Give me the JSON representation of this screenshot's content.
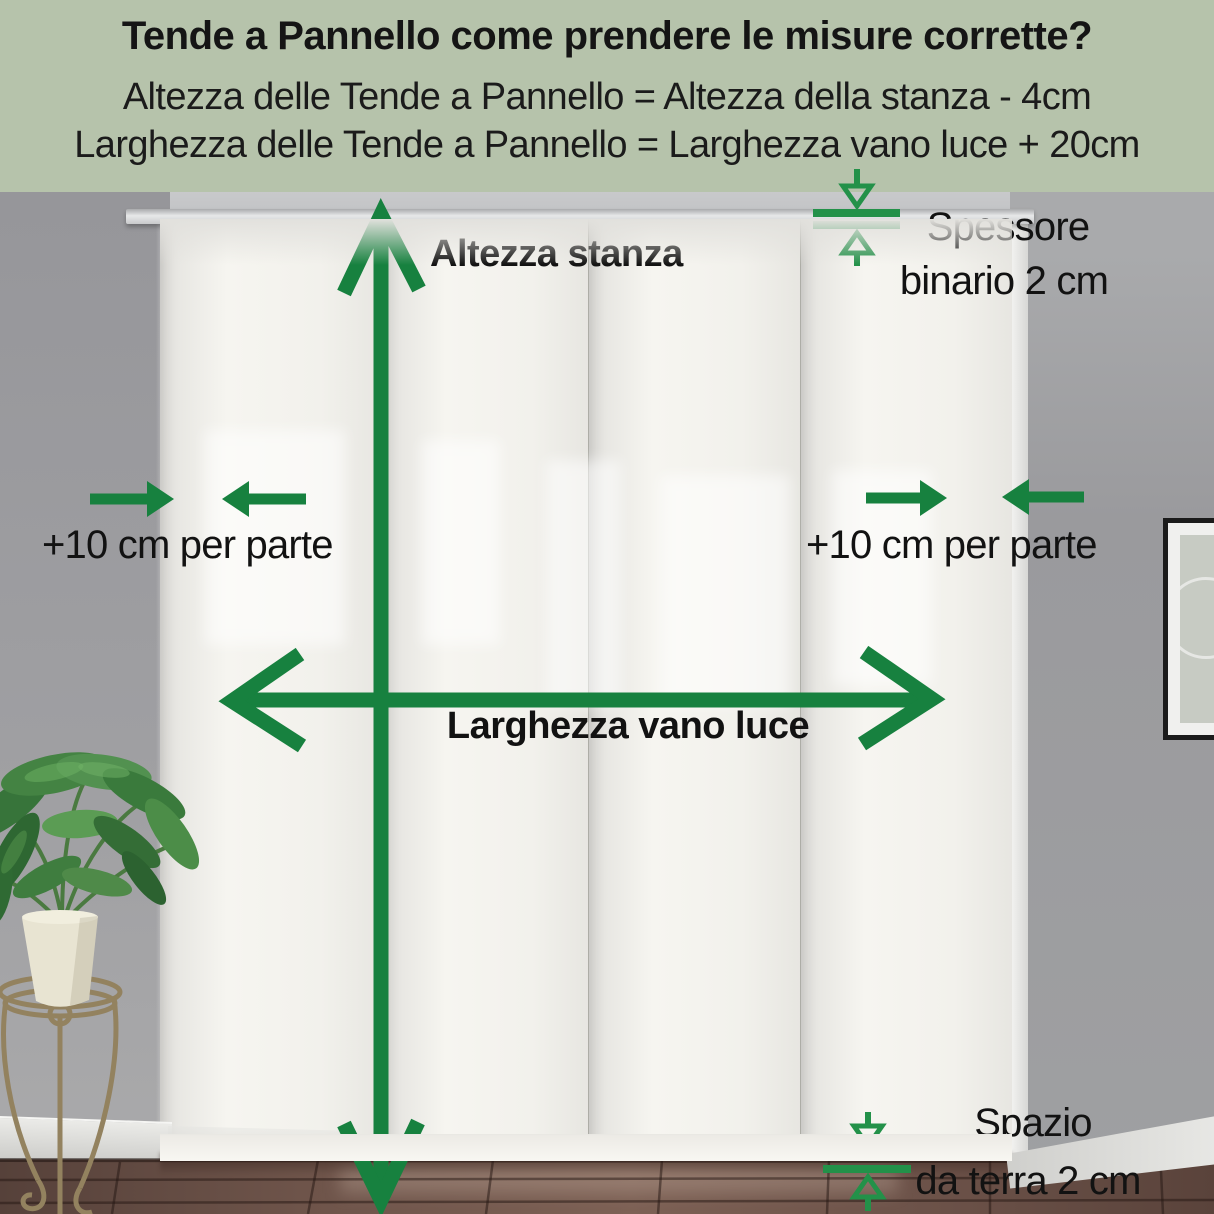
{
  "header": {
    "title": "Tende a Pannello come prendere le misure corrette?",
    "formula_height": "Altezza delle Tende a Pannello = Altezza della stanza - 4cm",
    "formula_width": "Larghezza delle Tende a Pannello = Larghezza vano luce + 20cm"
  },
  "annotations": {
    "room_height_label": "Altezza stanza",
    "opening_width_label": "Larghezza vano luce",
    "track_thickness_label_line1": "Spessore",
    "track_thickness_label_line2": "binario 2 cm",
    "side_allowance_left_label": "+10 cm per parte",
    "side_allowance_right_label": "+10 cm per parte",
    "floor_gap_label_line1": "Spazio",
    "floor_gap_label_line2": "da terra 2 cm"
  },
  "icons": {
    "room_height_arrow": "double-headed-vertical-arrow",
    "opening_width_arrow": "double-headed-horizontal-arrow",
    "side_allowance_left_arrows": "two-opposing-horizontal-arrows",
    "side_allowance_right_arrows": "two-opposing-horizontal-arrows",
    "track_thickness_gauge": "arrows-onto-parallel-lines",
    "floor_gap_gauge": "arrows-onto-parallel-lines"
  },
  "colors": {
    "header_background": "#b6c3ab",
    "annotation_green": "#17813f",
    "gauge_green": "#239149",
    "text_color": "#141414",
    "curtain_white": "#f2f1ec",
    "wall_gray": "#9b9b9d",
    "floor_brown": "#6b5148"
  }
}
